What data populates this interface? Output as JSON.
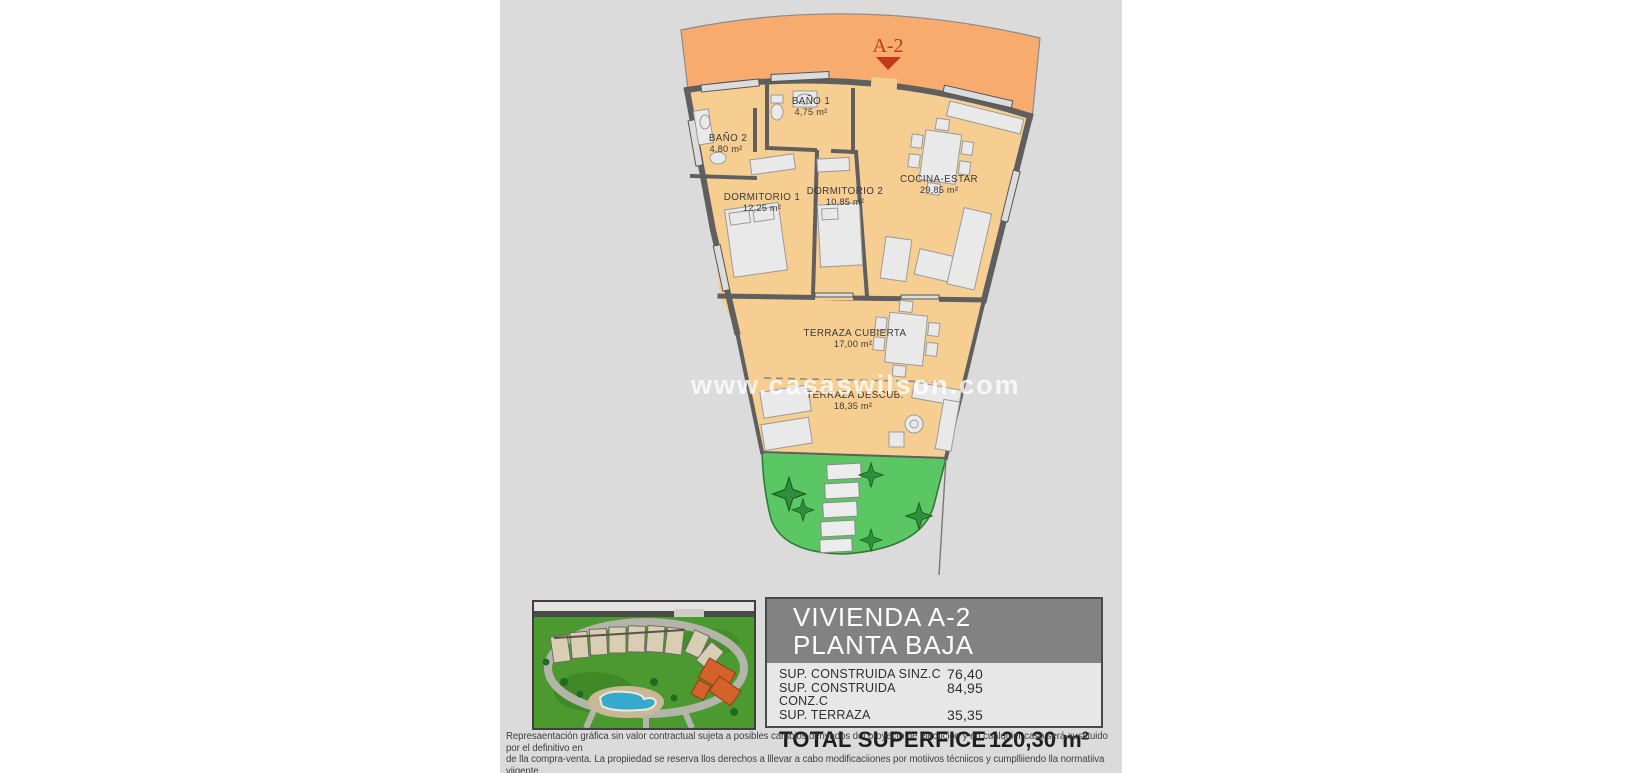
{
  "watermark": {
    "text": "www.casaswilson.com"
  },
  "floor_plan": {
    "unit_marker": "A-2",
    "rooms": [
      {
        "name": "BAÑO 1",
        "area": "4,75 m²"
      },
      {
        "name": "BAÑO 2",
        "area": "4,80 m²"
      },
      {
        "name": "DORMITORIO 1",
        "area": "12,25 m²"
      },
      {
        "name": "DORMITORIO 2",
        "area": "10,85 m²"
      },
      {
        "name": "COCINA-ESTAR",
        "area": "29,85 m²"
      },
      {
        "name": "TERRAZA CUBIERTA",
        "area": "17,00 m²"
      },
      {
        "name": "TERRAZA DESCUB.",
        "area": "18,35 m²"
      }
    ]
  },
  "info_panel": {
    "title_line1": "VIVIENDA A-2",
    "title_line2": "PLANTA BAJA",
    "rows": [
      {
        "label": "SUP. CONSTRUIDA SINZ.C",
        "value": "76,40"
      },
      {
        "label": "SUP. CONSTRUIDA CONZ.C",
        "value": "84,95"
      },
      {
        "label": "SUP. TERRAZA",
        "value": "35,35"
      }
    ],
    "total_label": "TOTAL SUPERFICE",
    "total_value": "120,30 m²"
  },
  "disclaimer": {
    "line1": "Represaentación gráfica sin valor contractual sujeta a posibles cambios derivados del proyecto de ejecución y en cualquier caso será sustituido por el definitivo en",
    "line2": "de lla compra-venta. La propiiedad se reserva llos derechos a lllevar a cabo modificaciiones por motiivos técniicos y cumplliiendo lla normatiiva viigente."
  },
  "colors": {
    "canvas_bg": "#dbdbdb",
    "plan_floor": "#f7ce92",
    "band_orange": "#f8ab6f",
    "marker_red": "#bf3a1d",
    "wall_gray": "#5f5f5f",
    "garden_green": "#5bc764",
    "panel_header_gray": "#828282",
    "pool_blue": "#35a9ce",
    "highlight_orange": "#d4622a"
  }
}
